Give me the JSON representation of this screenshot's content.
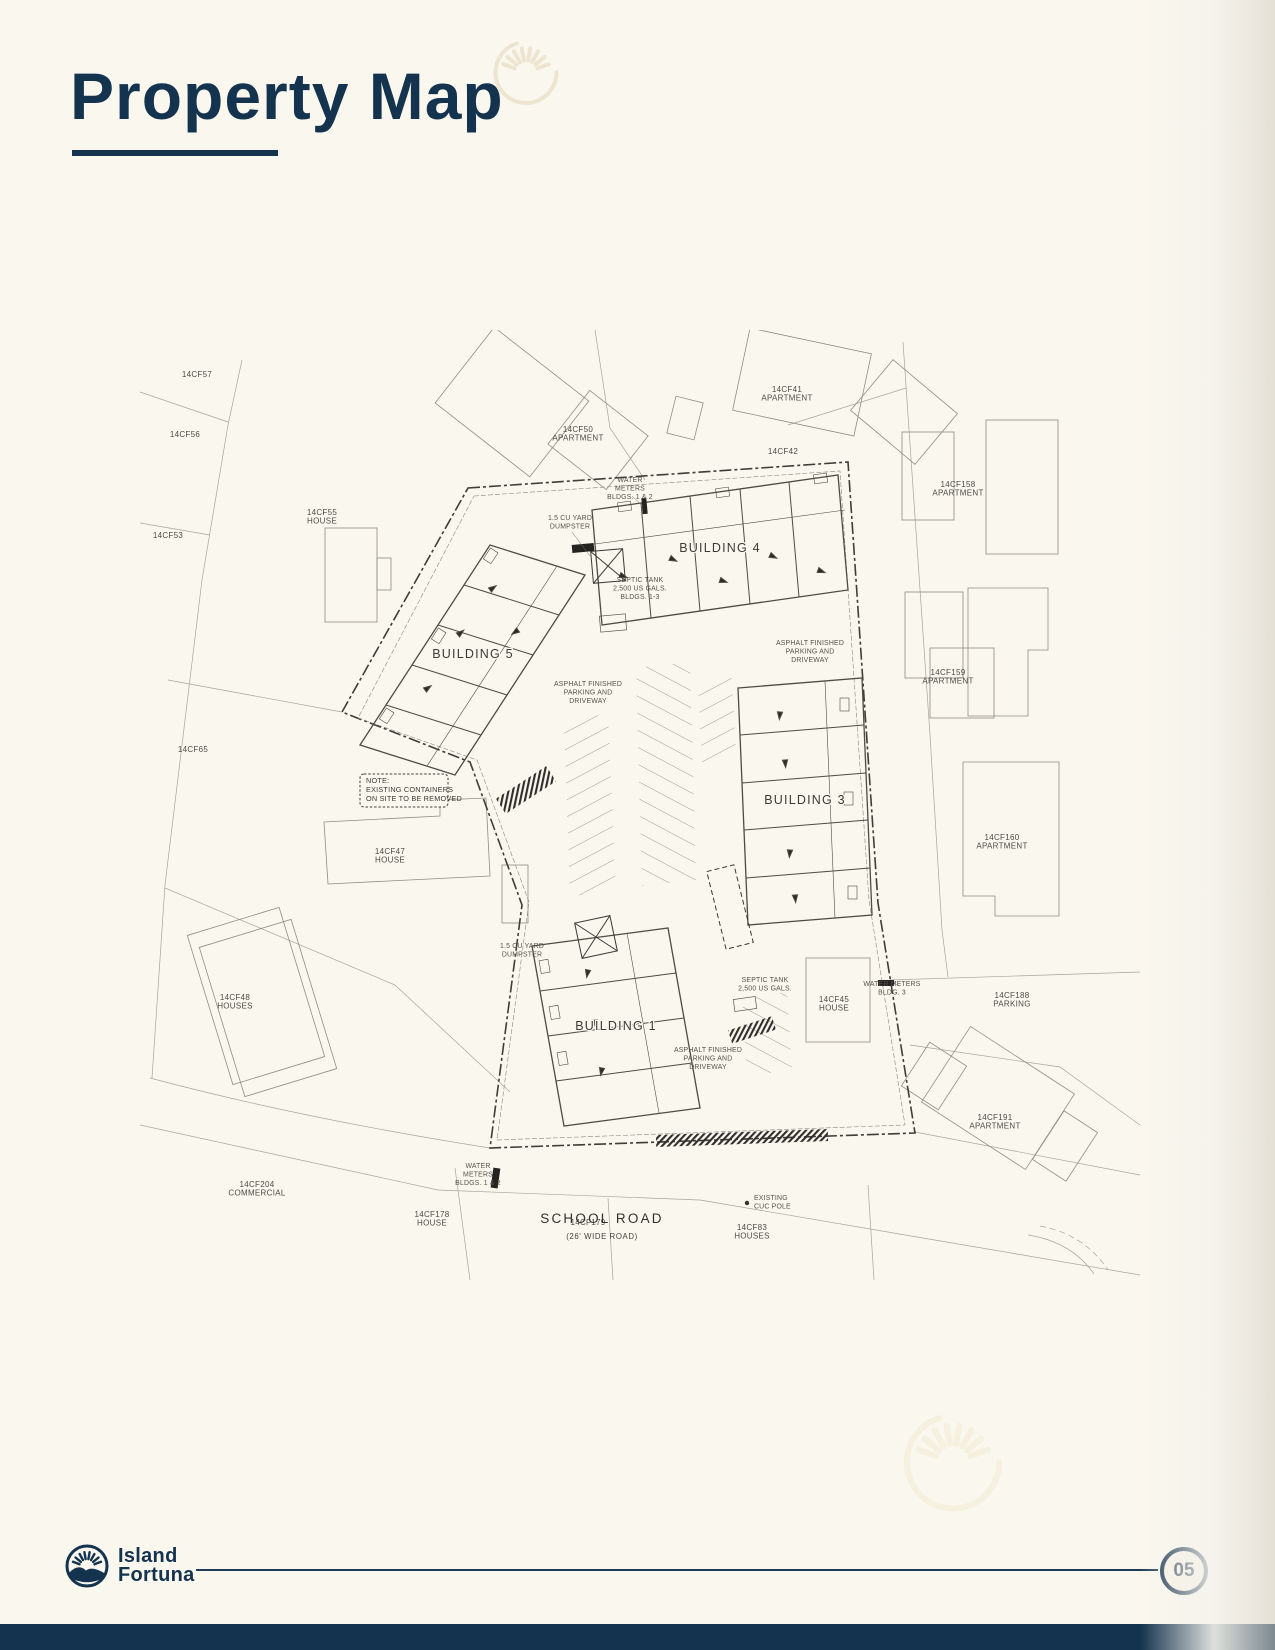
{
  "page": {
    "title": "Property Map",
    "page_number": "05"
  },
  "brand": {
    "line1": "Island",
    "line2": "Fortuna"
  },
  "colors": {
    "navy": "#14334e",
    "cream": "#faf7ee",
    "drawing_dark": "#3f3d38",
    "drawing_light": "#a8a49a"
  },
  "map": {
    "road": {
      "name": "SCHOOL ROAD",
      "sub": "(26' WIDE ROAD)"
    },
    "buildings": [
      {
        "label": "BUILDING 5",
        "x": 333,
        "y": 328
      },
      {
        "label": "BUILDING 4",
        "x": 580,
        "y": 222
      },
      {
        "label": "BUILDING 3",
        "x": 665,
        "y": 474
      },
      {
        "label": "BUILDING 1",
        "x": 476,
        "y": 700
      }
    ],
    "parcels": [
      {
        "id": "14CF57",
        "type": ""
      },
      {
        "id": "14CF56",
        "type": ""
      },
      {
        "id": "14CF53",
        "type": ""
      },
      {
        "id": "14CF55",
        "type": "HOUSE"
      },
      {
        "id": "14CF50",
        "type": "APARTMENT"
      },
      {
        "id": "14CF41",
        "type": "APARTMENT"
      },
      {
        "id": "14CF42",
        "type": ""
      },
      {
        "id": "14CF158",
        "type": "APARTMENT"
      },
      {
        "id": "14CF159",
        "type": "APARTMENT"
      },
      {
        "id": "14CF160",
        "type": "APARTMENT"
      },
      {
        "id": "14CF65",
        "type": ""
      },
      {
        "id": "14CF47",
        "type": "HOUSE"
      },
      {
        "id": "14CF48",
        "type": "HOUSES"
      },
      {
        "id": "14CF204",
        "type": "COMMERCIAL"
      },
      {
        "id": "14CF178",
        "type": "HOUSE"
      },
      {
        "id": "14CF179",
        "type": ""
      },
      {
        "id": "14CF83",
        "type": "HOUSES"
      },
      {
        "id": "14CF45",
        "type": "HOUSE"
      },
      {
        "id": "14CF188",
        "type": "PARKING"
      },
      {
        "id": "14CF191",
        "type": "APARTMENT"
      }
    ],
    "annotations": [
      {
        "name": "water-meters-top",
        "lines": [
          "WATER",
          "METERS",
          "BLDGS. 1 & 2"
        ]
      },
      {
        "name": "dumpster-top",
        "lines": [
          "1.5 CU YARD",
          "DUMPSTER"
        ]
      },
      {
        "name": "septic-tank-top",
        "lines": [
          "SEPTIC TANK",
          "2,500 US GALS.",
          "BLDGS. 1-3"
        ]
      },
      {
        "name": "asphalt-bldg5",
        "lines": [
          "ASPHALT FINISHED",
          "PARKING AND",
          "DRIVEWAY"
        ]
      },
      {
        "name": "asphalt-bldg4",
        "lines": [
          "ASPHALT FINISHED",
          "PARKING AND",
          "DRIVEWAY"
        ]
      },
      {
        "name": "asphalt-bldg1",
        "lines": [
          "ASPHALT FINISHED",
          "PARKING AND",
          "DRIVEWAY"
        ]
      },
      {
        "name": "dumpster-mid",
        "lines": [
          "1.5 CU YARD",
          "DUMPSTER"
        ]
      },
      {
        "name": "septic-tank-bldg1",
        "lines": [
          "SEPTIC TANK",
          "2,500 US GALS."
        ]
      },
      {
        "name": "water-meters-bottom",
        "lines": [
          "WATER",
          "METERS",
          "BLDGS. 1 & 2"
        ]
      },
      {
        "name": "water-meters-bldg3",
        "lines": [
          "WATER METERS",
          "BLDG. 3"
        ]
      },
      {
        "name": "cuc-pole",
        "lines": [
          "EXISTING",
          "CUC POLE"
        ]
      }
    ],
    "note": {
      "lines": [
        "NOTE:",
        "EXISTING CONTAINERS",
        "ON SITE TO BE REMOVED"
      ]
    }
  }
}
